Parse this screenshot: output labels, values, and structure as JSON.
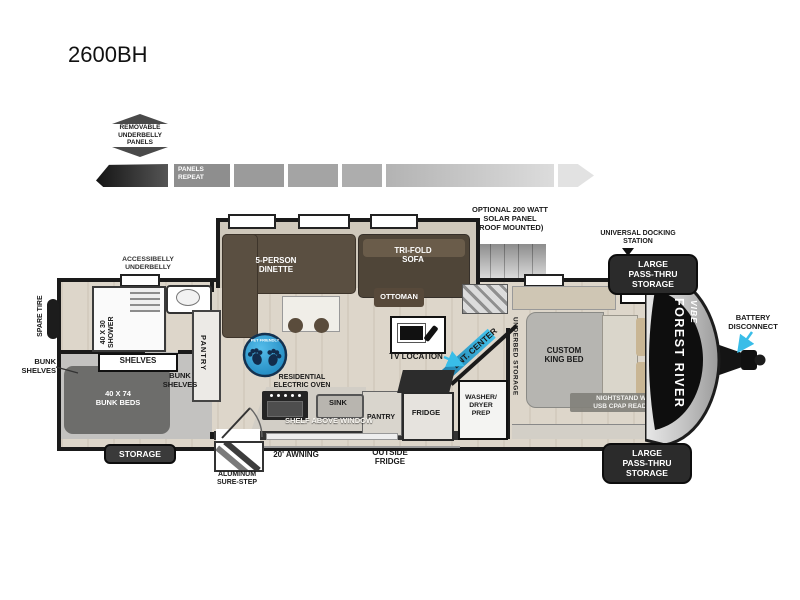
{
  "title": "2600BH",
  "underbelly": {
    "badge": "REMOVABLE\nUNDERBELLY\nPANELS",
    "strip": "PANELS\nREPEAT"
  },
  "exterior": {
    "solar": "OPTIONAL 200 WATT\nSOLAR PANEL\n(ROOF MOUNTED)",
    "docking": "UNIVERSAL DOCKING\nSTATION",
    "pass_thru": "LARGE\nPASS-THRU\nSTORAGE",
    "battery": "BATTERY\nDISCONNECT",
    "spare_tire": "SPARE TIRE",
    "accessibelly": "ACCESSIBELLY\nUNDERBELLY",
    "bunk_shelves_callout": "BUNK\nSHELVES",
    "storage": "STORAGE",
    "sure_step": "ALUMINUM\nSURE-STEP",
    "awning": "20' AWNING",
    "outside_fridge": "OUTSIDE\nFRIDGE"
  },
  "interior": {
    "shower": "40 X 30\nSHOWER",
    "shelves": "SHELVES",
    "bunk_shelves": "BUNK\nSHELVES",
    "bunk_beds": "40 X 74\nBUNK BEDS",
    "pantry_side": "PANTRY",
    "dinette": "5-PERSON\nDINETTE",
    "sofa": "TRI-FOLD\nSOFA",
    "ottoman": "OTTOMAN",
    "tv": "TV LOCATION",
    "ent_center": "ENT. CENTER",
    "oven": "RESIDENTIAL\nELECTRIC OVEN",
    "sink": "SINK",
    "shelf_window": "SHELF ABOVE WINDOW",
    "pantry_kitchen": "PANTRY",
    "fridge": "FRIDGE",
    "washer": "WASHER/\nDRYER\nPREP",
    "underbed": "UNDERBED STORAGE",
    "king_bed": "CUSTOM\nKING BED",
    "ward": "WARD",
    "nightstand": "NIGHTSTAND W/\nUSB CPAP READY"
  },
  "brand": {
    "maker": "FOREST RIVER",
    "model": "VIBE"
  },
  "badges": {
    "pet": "PET FRIENDLY"
  },
  "colors": {
    "accent_cyan": "#39bde8",
    "pet_blue": "#2aa2da",
    "ent_teal": "#2e9ec7",
    "wall": "#1a1a1a",
    "label_pill": "#2b2b2b",
    "sofa_brown": "#55493b",
    "bed_gray": "#b6b5b1"
  }
}
